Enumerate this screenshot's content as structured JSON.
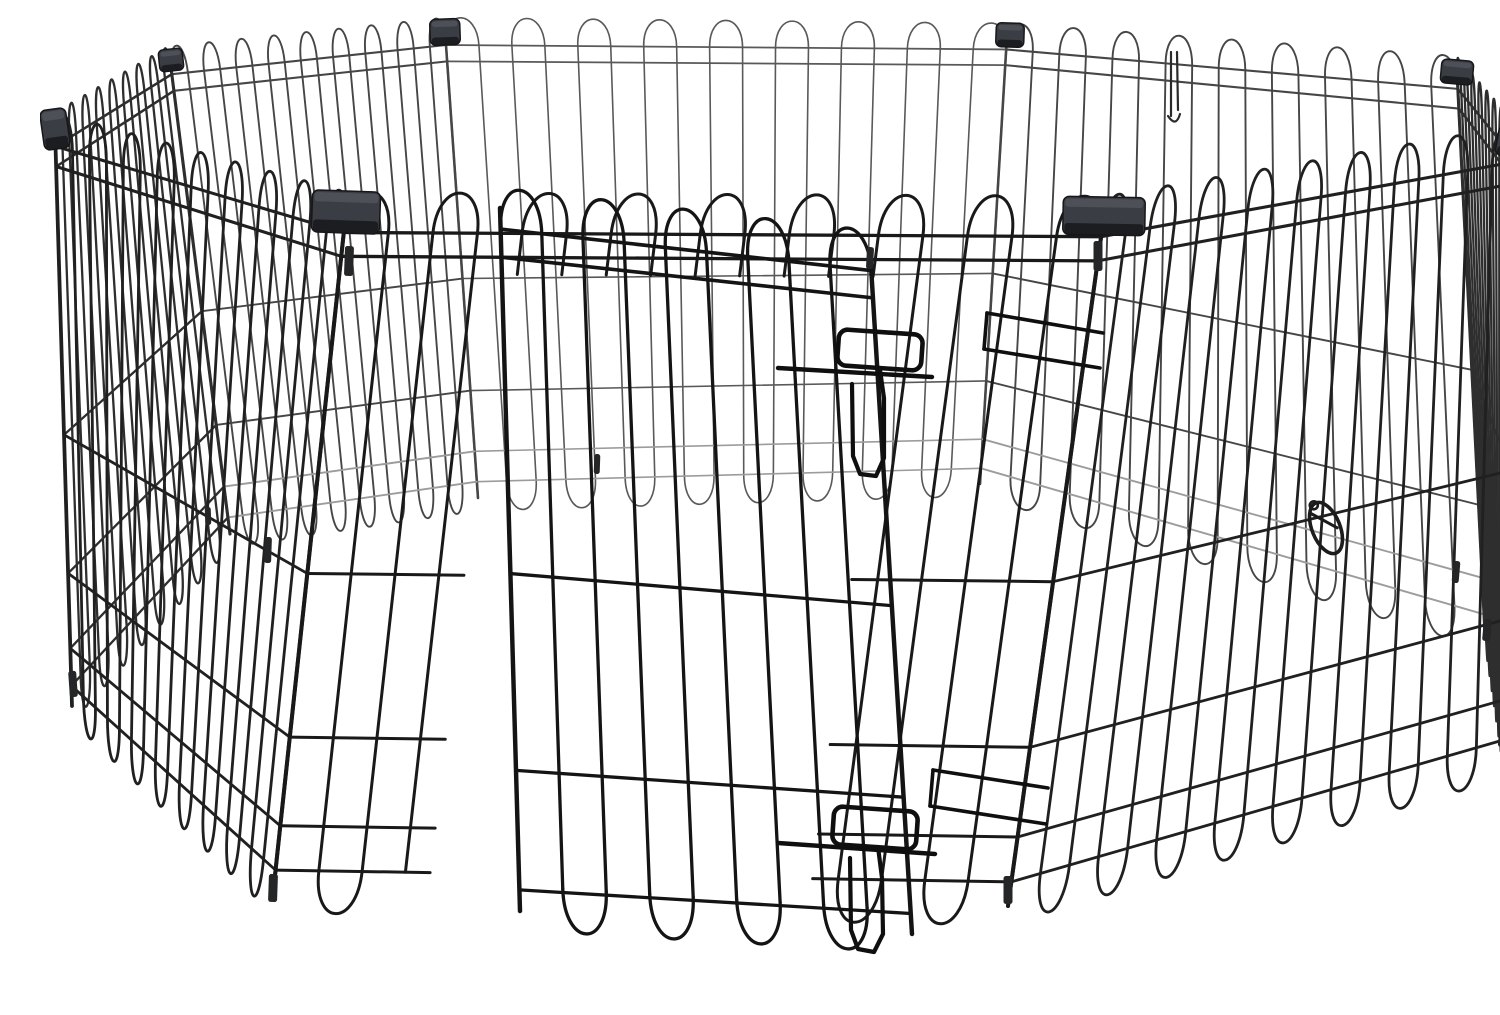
{
  "figure": {
    "kind": "product-photo",
    "subject": "Black foldable metal wire pet exercise playpen, octagonal, eight panels with top corner clips and a front door with two slide-bolt latches, on a white background"
  },
  "palette": {
    "background": "#ffffff",
    "wire_front": "#191919",
    "wire_near": "#202020",
    "wire_side": "#2e2e2e",
    "wire_mid": "#464646",
    "wire_far": "#595959",
    "wire_light": "#9c9c9c",
    "door_wire": "#141414",
    "latch_wire": "#0f0f0f",
    "clip_body": "#3a3e44",
    "clip_edge": "#16171a",
    "clip_highlight": "#5c6168",
    "ferrule": "#242628"
  },
  "scene": {
    "width": 1500,
    "height": 983,
    "shoulder": 0.03,
    "bottom_bar": 0.965,
    "arc_rise": 0.048,
    "panels": [
      {
        "name": "panel-back",
        "quad": {
          "tl": [
            405,
            15
          ],
          "tr": [
            967,
            20
          ],
          "bl": [
            438,
            482
          ],
          "br": [
            940,
            468
          ]
        },
        "verticals": 18,
        "horizontals": [
          0.03,
          0.065,
          0.53,
          0.77,
          0.9,
          0.965
        ],
        "light": [
          0.9,
          0.965
        ],
        "color": "#595959",
        "light_color": "#9c9c9c",
        "width": 1.6
      },
      {
        "name": "panel-left-back",
        "quad": {
          "tl": [
            130,
            44
          ],
          "tr": [
            405,
            15
          ],
          "bl": [
            190,
            518
          ],
          "br": [
            438,
            482
          ]
        },
        "verticals": 18,
        "horizontals": [
          0.03,
          0.065,
          0.53,
          0.77,
          0.9,
          0.965
        ],
        "light": [
          0.9,
          0.965
        ],
        "color": "#464646",
        "light_color": "#9c9c9c",
        "width": 1.9
      },
      {
        "name": "panel-right-back",
        "quad": {
          "tl": [
            967,
            20
          ],
          "tr": [
            1417,
            56
          ],
          "bl": [
            940,
            468
          ],
          "br": [
            1445,
            618
          ]
        },
        "verticals": 18,
        "horizontals": [
          0.03,
          0.065,
          0.53,
          0.77,
          0.9,
          0.965
        ],
        "light": [
          0.9,
          0.965
        ],
        "color": "#464646",
        "light_color": "#9c9c9c",
        "width": 1.9
      },
      {
        "name": "panel-left",
        "quad": {
          "tl": [
            15,
            113
          ],
          "tr": [
            130,
            44
          ],
          "bl": [
            32,
            690
          ],
          "br": [
            190,
            518
          ]
        },
        "verticals": 18,
        "horizontals": [
          0.03,
          0.065,
          0.53,
          0.77,
          0.9,
          0.965
        ],
        "light": [],
        "color": "#2e2e2e",
        "light_color": "#6e6e6e",
        "width": 2.3
      },
      {
        "name": "panel-right",
        "quad": {
          "tl": [
            1417,
            56
          ],
          "tr": [
            1477,
            127
          ],
          "bl": [
            1445,
            618
          ],
          "br": [
            1465,
            745
          ]
        },
        "verticals": 18,
        "horizontals": [
          0.03,
          0.065,
          0.53,
          0.77,
          0.9,
          0.965
        ],
        "light": [],
        "color": "#2e2e2e",
        "light_color": "#6e6e6e",
        "width": 2.3
      },
      {
        "name": "panel-front-left",
        "quad": {
          "tl": [
            15,
            113
          ],
          "tr": [
            306,
            196
          ],
          "bl": [
            32,
            690
          ],
          "br": [
            233,
            878
          ]
        },
        "verticals": 18,
        "horizontals": [
          0.03,
          0.065,
          0.53,
          0.77,
          0.9,
          0.965
        ],
        "light": [],
        "color": "#202020",
        "light_color": "#6e6e6e",
        "width": 2.8
      },
      {
        "name": "panel-front-right",
        "quad": {
          "tl": [
            1064,
            200
          ],
          "tr": [
            1477,
            127
          ],
          "bl": [
            968,
            890
          ],
          "br": [
            1465,
            745
          ]
        },
        "verticals": 18,
        "horizontals": [
          0.03,
          0.065,
          0.53,
          0.77,
          0.9,
          0.965
        ],
        "light": [],
        "color": "#202020",
        "light_color": "#6e6e6e",
        "width": 2.8
      },
      {
        "name": "panel-front",
        "quad": {
          "tl": [
            306,
            196
          ],
          "tr": [
            1064,
            200
          ],
          "bl": [
            233,
            878
          ],
          "br": [
            968,
            890
          ]
        },
        "verticals": 18,
        "horizontals": [
          0.03,
          0.065,
          0.53,
          0.77,
          0.9,
          0.965
        ],
        "light": [],
        "color": "#191919",
        "light_color": "#6e6e6e",
        "width": 3.0,
        "opening": {
          "t1": 0.21,
          "t2": 0.73,
          "f": 0.09
        }
      }
    ],
    "door": {
      "name": "door-panel",
      "quad": {
        "tl": [
          460,
          192
        ],
        "tr": [
          830,
          234
        ],
        "bl": [
          480,
          895
        ],
        "br": [
          872,
          918
        ]
      },
      "verticals": 10,
      "horizontals": [
        0.03,
        0.07,
        0.52,
        0.8,
        0.97
      ],
      "light": [],
      "color": "#141414",
      "light_color": "#6e6e6e",
      "width": 3.3
    },
    "latches": [
      {
        "name": "door-latch-top",
        "handle": {
          "x": 798,
          "y": 316,
          "w": 84,
          "h": 36,
          "rx": 9,
          "rot": 4
        },
        "rod": [
          [
            738,
            352
          ],
          [
            892,
            361
          ]
        ],
        "drop": [
          [
            840,
            354
          ],
          [
            844,
            382
          ],
          [
            844,
            442
          ],
          [
            836,
            460
          ],
          [
            820,
            458
          ],
          [
            813,
            440
          ],
          [
            812,
            368
          ]
        ]
      },
      {
        "name": "door-latch-bottom",
        "handle": {
          "x": 793,
          "y": 793,
          "w": 84,
          "h": 38,
          "rx": 9,
          "rot": 4
        },
        "rod": [
          [
            738,
            827
          ],
          [
            895,
            838
          ]
        ],
        "drop": [
          [
            838,
            831
          ],
          [
            842,
            862
          ],
          [
            843,
            918
          ],
          [
            834,
            936
          ],
          [
            818,
            933
          ],
          [
            811,
            914
          ],
          [
            810,
            842
          ]
        ]
      }
    ],
    "keepers": [
      {
        "name": "latch-keeper-top",
        "bars": [
          [
            [
              947,
              297
            ],
            [
              1063,
              317
            ]
          ],
          [
            [
              944,
              333
            ],
            [
              1060,
              352
            ]
          ]
        ],
        "cap": [
          [
            947,
            297
          ],
          [
            944,
            333
          ]
        ]
      },
      {
        "name": "latch-keeper-bottom",
        "bars": [
          [
            [
              893,
              754
            ],
            [
              1008,
              772
            ]
          ],
          [
            [
              890,
              790
            ],
            [
              1006,
              808
            ]
          ]
        ],
        "cap": [
          [
            893,
            754
          ],
          [
            890,
            790
          ]
        ]
      }
    ],
    "clips": [
      {
        "name": "corner-clip-left",
        "cx": 15,
        "cy": 113,
        "w": 26,
        "h": 40,
        "rot": -8
      },
      {
        "name": "corner-clip-left-back",
        "cx": 131,
        "cy": 44,
        "w": 24,
        "h": 22,
        "rot": -6
      },
      {
        "name": "corner-clip-back-left",
        "cx": 405,
        "cy": 16,
        "w": 30,
        "h": 26,
        "rot": -2
      },
      {
        "name": "corner-clip-back-right",
        "cx": 970,
        "cy": 19,
        "w": 28,
        "h": 24,
        "rot": 2
      },
      {
        "name": "corner-clip-right-back",
        "cx": 1417,
        "cy": 56,
        "w": 32,
        "h": 24,
        "rot": 5
      },
      {
        "name": "corner-clip-right",
        "cx": 1477,
        "cy": 127,
        "w": 40,
        "h": 30,
        "rot": 10
      },
      {
        "name": "corner-clip-front-left",
        "cx": 306,
        "cy": 196,
        "w": 68,
        "h": 42,
        "rot": 2
      },
      {
        "name": "corner-clip-front-right",
        "cx": 1064,
        "cy": 200,
        "w": 82,
        "h": 38,
        "rot": 1
      }
    ],
    "ferrules": [
      [
        309,
        245,
        9,
        30,
        2
      ],
      [
        228,
        534,
        7,
        26,
        2
      ],
      [
        233,
        872,
        9,
        28,
        2
      ],
      [
        33,
        668,
        8,
        26,
        -4
      ],
      [
        1058,
        240,
        9,
        30,
        0
      ],
      [
        968,
        874,
        9,
        28,
        0
      ],
      [
        1464,
        716,
        10,
        30,
        5
      ],
      [
        1480,
        156,
        7,
        20,
        8
      ],
      [
        1470,
        425,
        7,
        24,
        3
      ],
      [
        1416,
        556,
        7,
        22,
        5
      ],
      [
        1447,
        614,
        8,
        22,
        5
      ],
      [
        830,
        242,
        7,
        22,
        3
      ],
      [
        557,
        448,
        6,
        20,
        2
      ],
      [
        168,
        500,
        6,
        18,
        -2
      ]
    ],
    "carabiner": {
      "name": "snap-hook",
      "cx": 1286,
      "cy": 512,
      "rx": 14,
      "ry": 27,
      "rot": -22
    },
    "hanging_pin": {
      "name": "hinge-pin",
      "x": 1134,
      "y1": 36,
      "y2": 100
    }
  }
}
